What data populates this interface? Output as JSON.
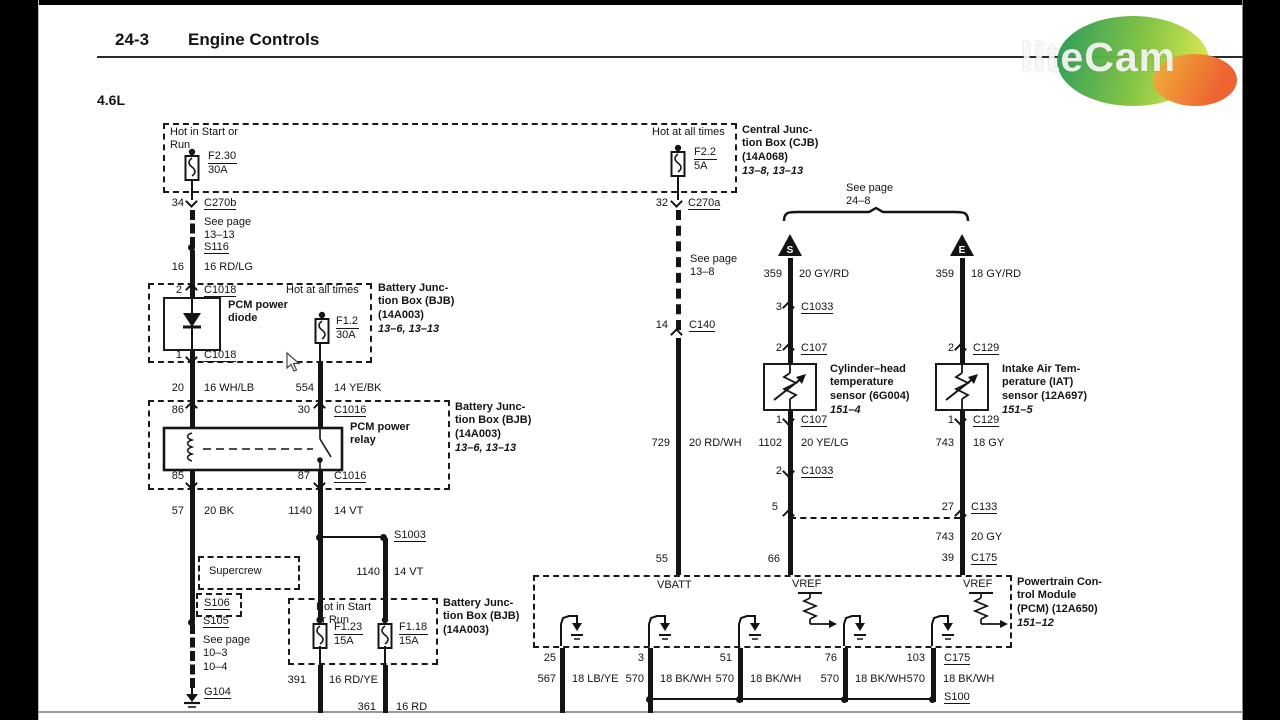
{
  "header": {
    "section": "24-3",
    "title": "Engine Controls",
    "engine": "4.6L",
    "watermark": "liteCam"
  },
  "cjb": {
    "label": "Central Junc-\ntion Box (CJB)\n(14A068)",
    "pages": "13–8, 13–13",
    "left_condition": "Hot in Start or\nRun",
    "left_fuse": "F2.30",
    "left_rating": "30A",
    "right_condition": "Hot at all times",
    "right_fuse": "F2.2",
    "right_rating": "5A",
    "pin34": "34",
    "c270b": "C270b",
    "pin32": "32",
    "c270a": "C270a"
  },
  "left": {
    "see_13_13": "See page\n13–13",
    "s116": "S116",
    "w16": {
      "num": "16",
      "color": "16 RD/LG"
    },
    "bjb1": {
      "pin2": "2",
      "c1018a": "C1018",
      "diode": "PCM power\ndiode",
      "hot": "Hot at all times",
      "fuse": "F1.2",
      "rating": "30A",
      "pin1": "1",
      "c1018b": "C1018",
      "label": "Battery Junc-\ntion Box (BJB)\n(14A003)",
      "pages": "13–6, 13–13"
    },
    "w20": {
      "num": "20",
      "color": "16 WH/LB"
    },
    "w554": {
      "num": "554",
      "color": "14 YE/BK"
    },
    "bjb2": {
      "pin86": "86",
      "pin30": "30",
      "c1016a": "C1016",
      "relay": "PCM power\nrelay",
      "pin85": "85",
      "pin87": "87",
      "c1016b": "C1016",
      "label": "Battery Junc-\ntion Box (BJB)\n(14A003)",
      "pages": "13–6, 13–13"
    },
    "w57": {
      "num": "57",
      "color": "20 BK"
    },
    "w1140a": {
      "num": "1140",
      "color": "14 VT"
    },
    "s1003": "S1003",
    "supercrew": "Supercrew",
    "s106": "S106",
    "s105": "S105",
    "see_10": "See page\n10–3\n10–4",
    "g104": "G104",
    "w1140b": {
      "num": "1140",
      "color": "14 VT"
    },
    "bjb3": {
      "hot": "Hot in Start\nor Run",
      "fuse1": "F1.23",
      "rating1": "15A",
      "fuse2": "F1.18",
      "rating2": "15A",
      "label": "Battery Junc-\ntion Box (BJB)\n(14A003)"
    },
    "w391": {
      "num": "391",
      "color": "16 RD/YE"
    },
    "w361": {
      "num": "361",
      "color": "16 RD"
    }
  },
  "middle": {
    "see_13_8": "See page\n13–8",
    "pin14": "14",
    "c140": "C140",
    "w729": {
      "num": "729",
      "color": "20 RD/WH"
    },
    "pin55": "55"
  },
  "sensors": {
    "see_24_8": "See page\n24–8",
    "arrow_s": "S",
    "arrow_e": "E",
    "cht": {
      "w359": {
        "num": "359",
        "color": "20 GY/RD"
      },
      "pin3": "3",
      "c1033a": "C1033",
      "pin2t": "2",
      "c107a": "C107",
      "label": "Cylinder–head\ntemperature\nsensor (6G004)",
      "page": "151–4",
      "pin1": "1",
      "c107b": "C107",
      "w1102": {
        "num": "1102",
        "color": "20 YE/LG"
      },
      "pin2b": "2",
      "c1033b": "C1033",
      "pin5": "5",
      "pin66": "66"
    },
    "iat": {
      "w359": {
        "num": "359",
        "color": "18 GY/RD"
      },
      "pin2": "2",
      "c129a": "C129",
      "label": "Intake Air Tem-\nperature (IAT)\nsensor (12A697)",
      "page": "151–5",
      "pin1": "1",
      "c129b": "C129",
      "w743a": {
        "num": "743",
        "color": "18 GY"
      },
      "pin27": "27",
      "c133": "C133",
      "w743b": {
        "num": "743",
        "color": "20 GY"
      },
      "pin39": "39",
      "c175": "C175"
    }
  },
  "pcm": {
    "vbatt": "VBATT",
    "vref1": "VREF",
    "vref2": "VREF",
    "label": "Powertrain Con-\ntrol Module\n(PCM) (12A650)",
    "page": "151–12",
    "pins": [
      "25",
      "3",
      "51",
      "76",
      "103"
    ],
    "c175": "C175",
    "wires": [
      {
        "num": "567",
        "color": "18 LB/YE"
      },
      {
        "num": "570",
        "color": "18 BK/WH"
      },
      {
        "num": "570",
        "color": "18 BK/WH"
      },
      {
        "num": "570",
        "color": "18 BK/WH"
      },
      {
        "num": "570",
        "color": "18 BK/WH"
      }
    ],
    "s100": "S100"
  }
}
